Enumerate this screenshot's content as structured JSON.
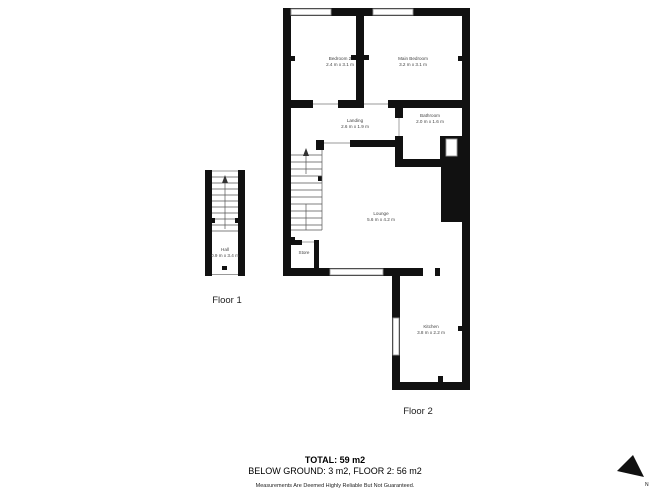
{
  "page": {
    "background": "#ffffff",
    "wall_color": "#111111"
  },
  "floor1": {
    "label": "Floor 1",
    "hall": {
      "name": "Hall",
      "dims": "0.9 m x 3.4 m"
    }
  },
  "floor2": {
    "label": "Floor 2",
    "bedroom2": {
      "name": "Bedroom 2",
      "dims": "2.4 m x 3.1 m"
    },
    "main_bedroom": {
      "name": "Main Bedroom",
      "dims": "3.2 m x 3.1 m"
    },
    "bathroom": {
      "name": "Bathroom",
      "dims": "2.0 m x 1.6 m"
    },
    "landing": {
      "name": "Landing",
      "dims": "2.6 m x 1.9 m"
    },
    "lounge": {
      "name": "Lounge",
      "dims": "5.6 m x 4.2 m"
    },
    "store": {
      "name": "Store"
    },
    "kitchen": {
      "name": "Kitchen",
      "dims": "3.8 m x 2.2 m"
    }
  },
  "summary": {
    "total": "TOTAL: 59 m2",
    "breakdown": "BELOW GROUND: 3 m2, FLOOR 2: 56 m2",
    "disclaimer": "Measurements Are Deemed Highly Reliable But Not Guaranteed."
  },
  "compass": {
    "label": "N"
  }
}
